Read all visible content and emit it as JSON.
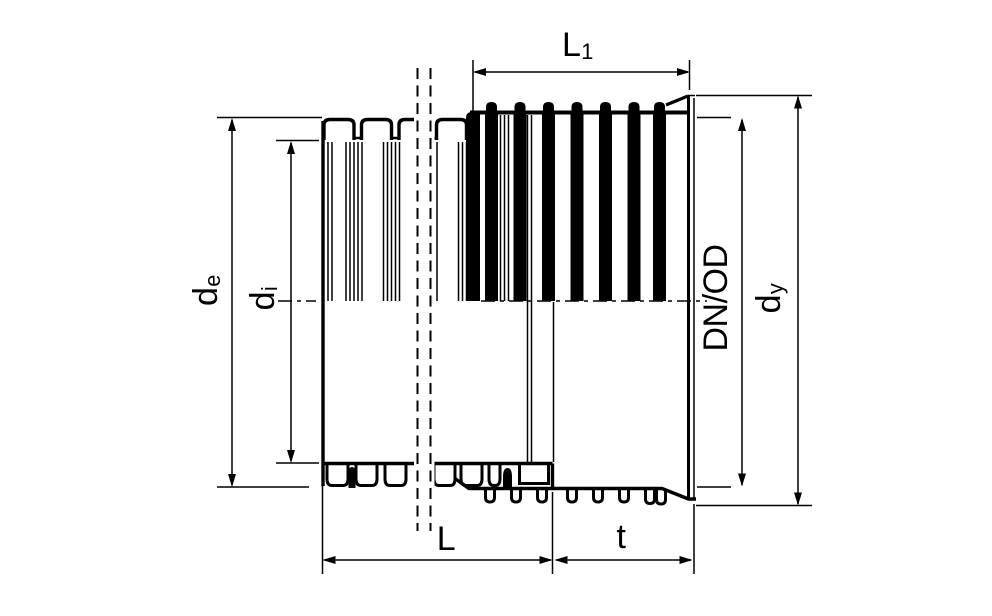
{
  "diagram": {
    "type": "technical-drawing",
    "subject": "corrugated-pipe-with-socket-cross-section",
    "colors": {
      "line": "#000000",
      "background": "#ffffff"
    },
    "labels": {
      "l1": {
        "main": "L",
        "sub": "1"
      },
      "de": {
        "main": "d",
        "sub": "e"
      },
      "di": {
        "main": "d",
        "sub": "i"
      },
      "dn_od": {
        "main": "DN/OD",
        "sub": ""
      },
      "dy": {
        "main": "d",
        "sub": "y"
      },
      "l": {
        "main": "L",
        "sub": ""
      },
      "t": {
        "main": "t",
        "sub": ""
      }
    }
  }
}
